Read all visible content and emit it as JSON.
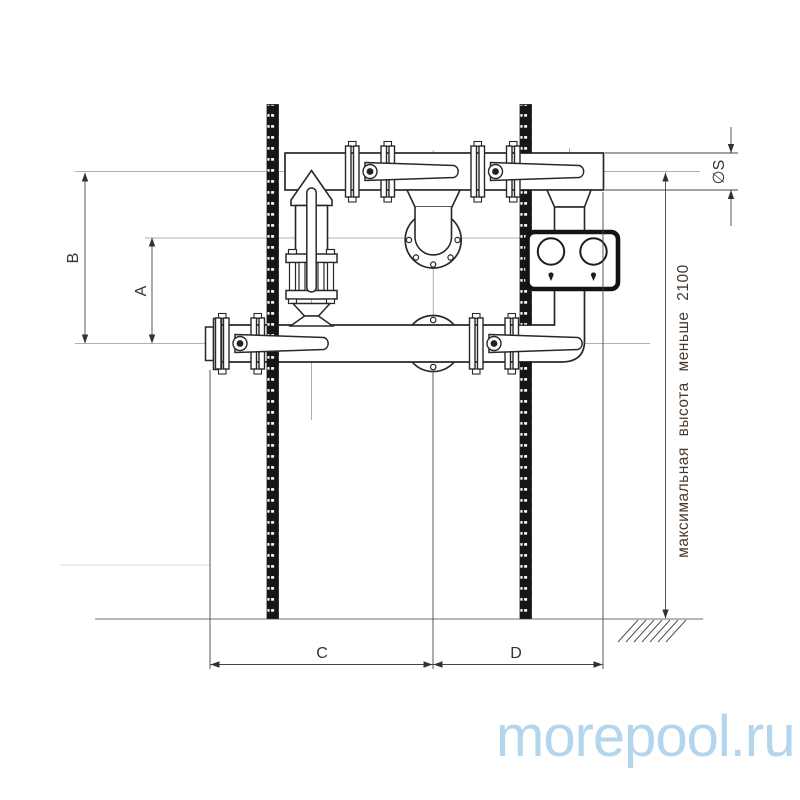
{
  "drawing": {
    "type": "technical-installation-diagram",
    "subject": "pool pump piping assembly with butterfly valves, gate valve and dual-gauge panel",
    "labels": {
      "b": "B",
      "a": "A",
      "c": "C",
      "d": "D",
      "pipe_diameter": "∅S"
    },
    "note_max_height": "максимальная высота меньше 2100",
    "watermark": "morepool.ru",
    "components": {
      "left_support_post": "perforated mounting post",
      "right_support_post": "perforated mounting post",
      "top_pipe": "upper horizontal pipe",
      "bottom_pipe": "lower horizontal pipe with elbow riser",
      "gate_valve": "vertical gate valve with lever",
      "butterfly_valves": "four flanged butterfly valves with levers",
      "front_flanges": "two round blind flanges",
      "gauge_panel": "dual round gauge control box",
      "ground": "ground line with hatching"
    },
    "colors": {
      "line": "#2b2726",
      "centerline": "#979797",
      "dimension": "#4a4542",
      "label_text": "#3a3230",
      "watermark": "#b4d6ec",
      "background": "#ffffff",
      "post_fill": "#161616"
    }
  }
}
